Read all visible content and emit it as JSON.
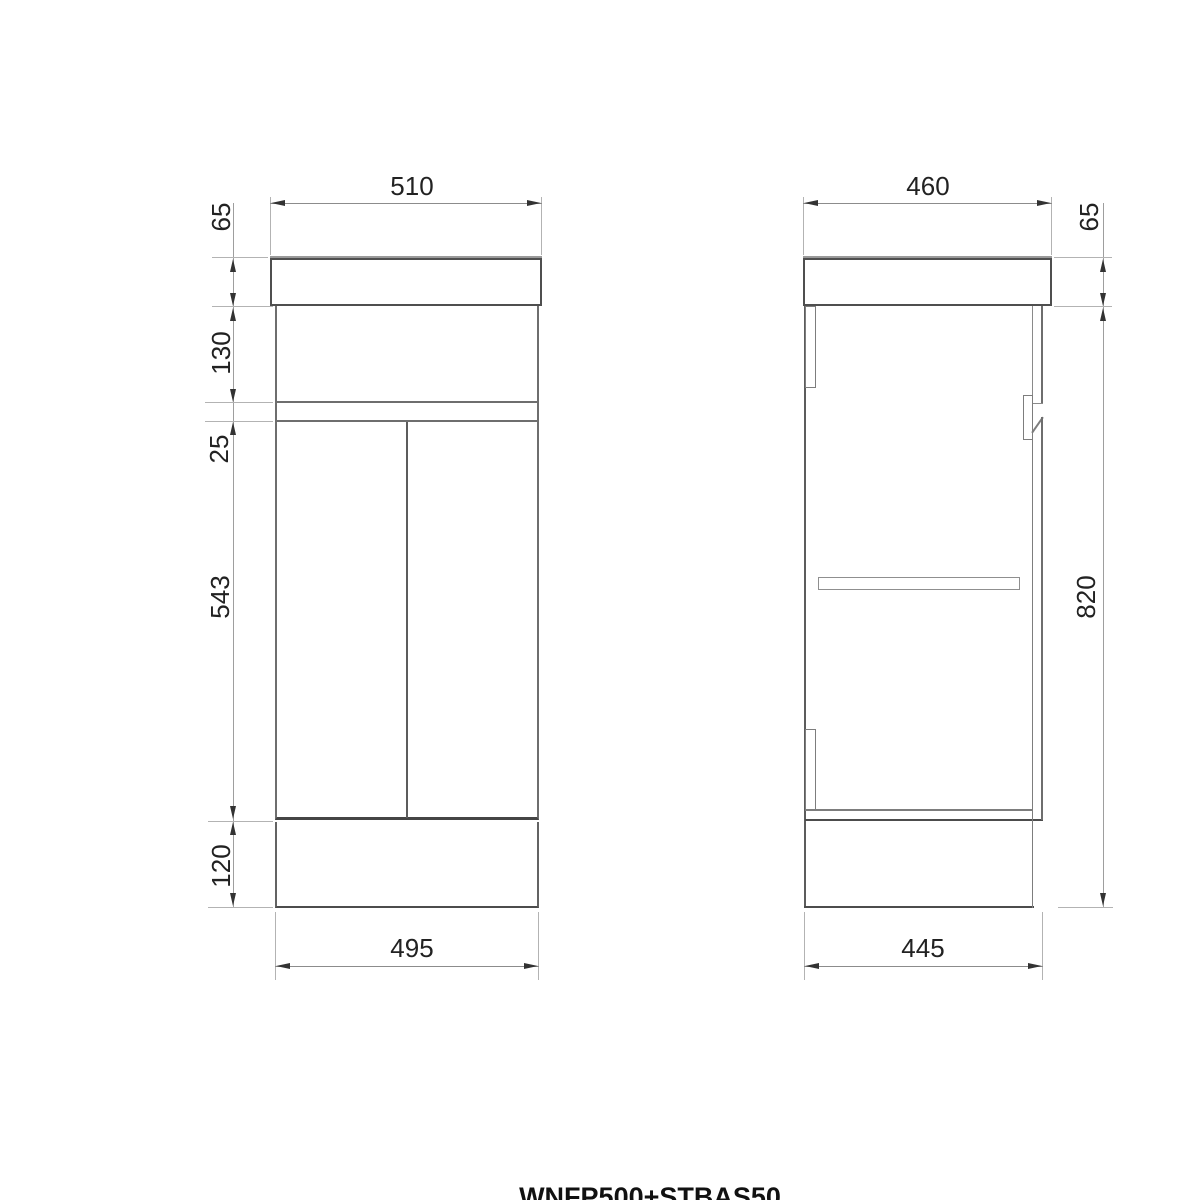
{
  "product_code": "WNFP500+STBAS50",
  "front_view": {
    "dim_top_width": "510",
    "dim_bottom_width": "495",
    "dim_basin_height": "65",
    "dim_panel_height": "130",
    "dim_rail_height": "25",
    "dim_door_height": "543",
    "dim_plinth_height": "120"
  },
  "side_view": {
    "dim_top_depth": "460",
    "dim_bottom_depth": "445",
    "dim_basin_height": "65",
    "dim_body_height": "820"
  },
  "colors": {
    "outline_dark": "#4f4f4f",
    "outline_mid": "#6e6e6e",
    "line_light": "#8a8a8a",
    "extension_line": "#b3b3b3",
    "arrow_text": "#222222"
  }
}
